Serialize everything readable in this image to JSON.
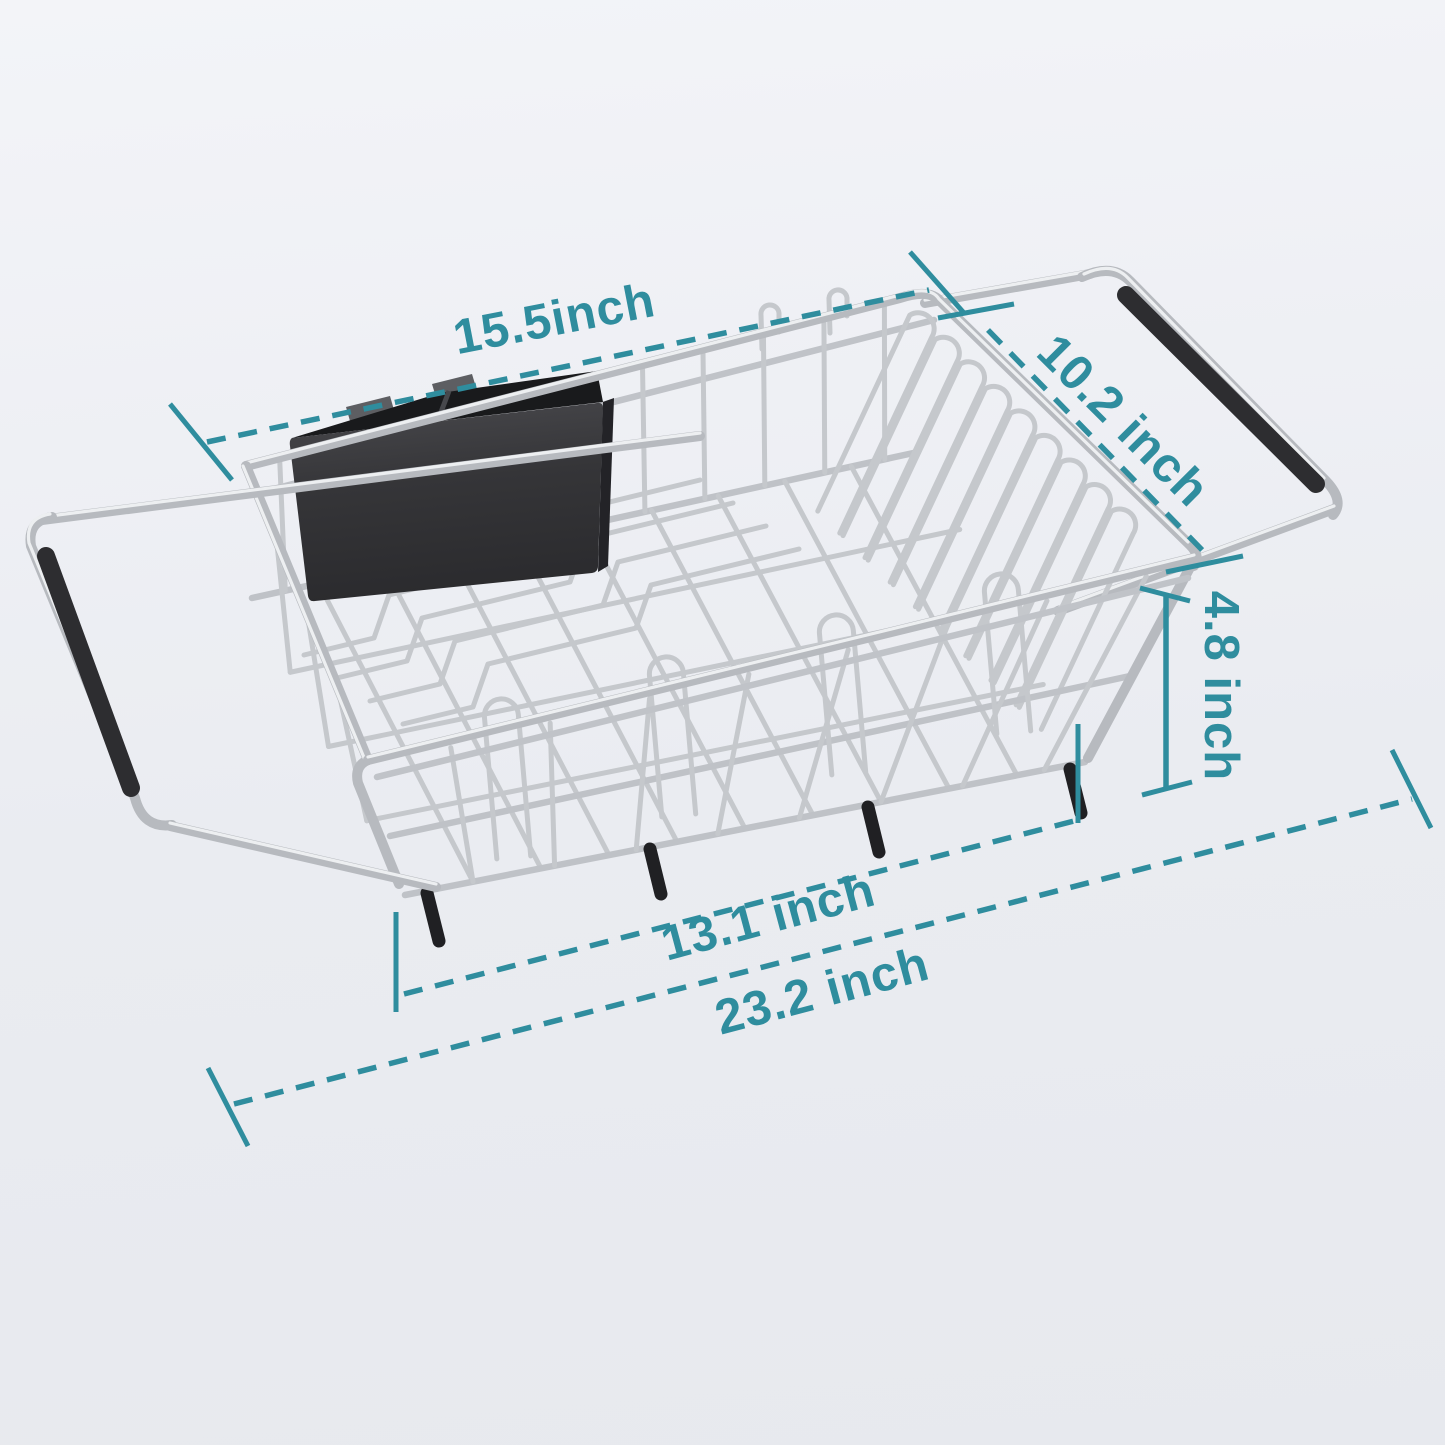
{
  "figure": {
    "type": "product-dimension-diagram",
    "product_name": "Expandable over-sink stainless steel dish drying rack with cutlery holder",
    "annotation_color": "#2f8d9e",
    "background_top": "#f3f4f8",
    "background_bottom": "#e7e9ee",
    "chrome_color": "#c3c6ca",
    "grip_color": "#2d2d30",
    "utensil_holder_color": "#3a3a3e"
  },
  "dimensions": {
    "top_length": {
      "label": "15.5inch",
      "value": 15.5,
      "unit": "inch"
    },
    "depth": {
      "label": "10.2 inch",
      "value": 10.2,
      "unit": "inch"
    },
    "height": {
      "label": "4.8 inch",
      "value": 4.8,
      "unit": "inch"
    },
    "inner_length": {
      "label": "13.1 inch",
      "value": 13.1,
      "unit": "inch"
    },
    "extended_length": {
      "label": "23.2 inch",
      "value": 23.2,
      "unit": "inch"
    }
  }
}
